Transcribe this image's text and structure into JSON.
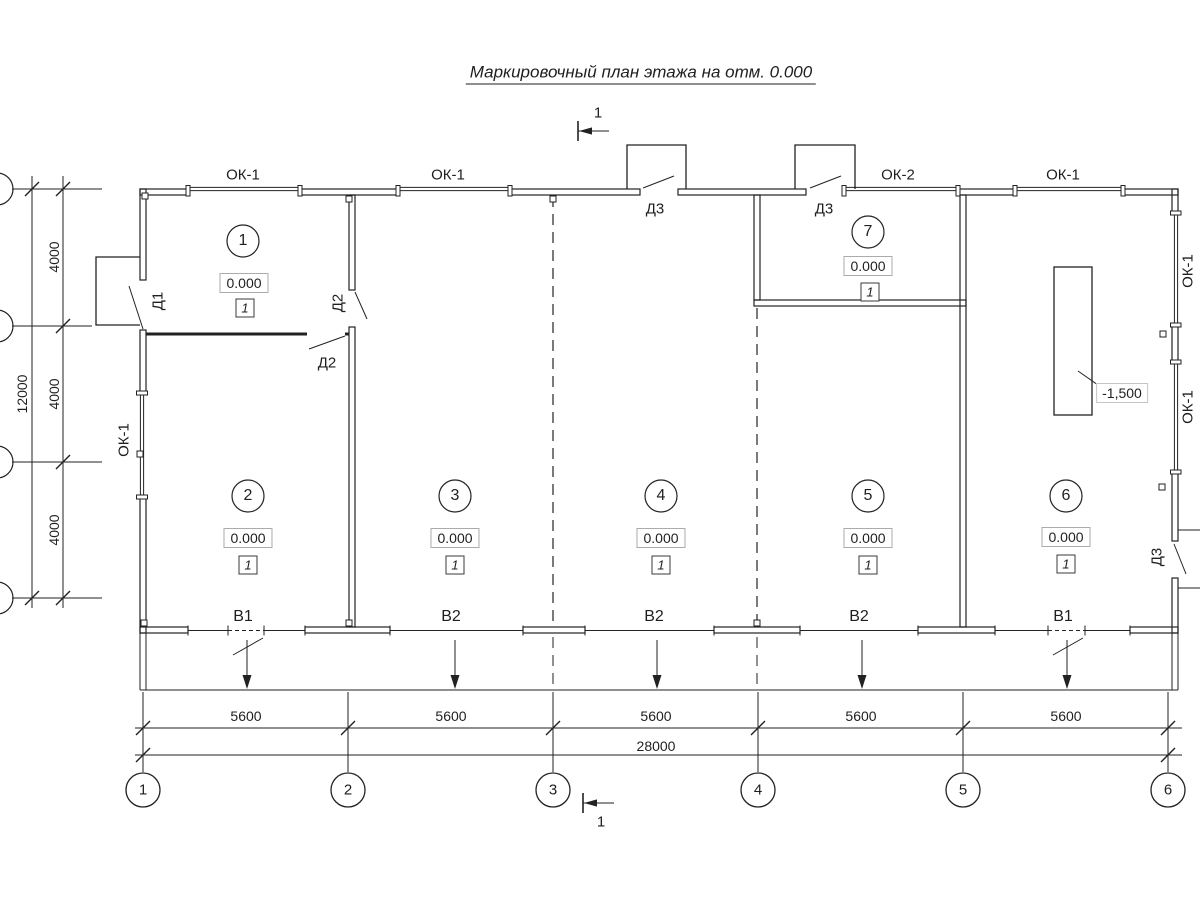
{
  "title": "Маркировочный план этажа на отм. 0.000",
  "section_mark": {
    "top": "1",
    "bottom": "1"
  },
  "rooms": [
    {
      "number": "1",
      "elevation": "0.000",
      "floor_type": "1"
    },
    {
      "number": "2",
      "elevation": "0.000",
      "floor_type": "1"
    },
    {
      "number": "3",
      "elevation": "0.000",
      "floor_type": "1"
    },
    {
      "number": "4",
      "elevation": "0.000",
      "floor_type": "1"
    },
    {
      "number": "5",
      "elevation": "0.000",
      "floor_type": "1"
    },
    {
      "number": "6",
      "elevation": "0.000",
      "floor_type": "1"
    },
    {
      "number": "7",
      "elevation": "0.000",
      "floor_type": "1"
    }
  ],
  "window_labels": {
    "top": [
      {
        "label": "ОК-1"
      },
      {
        "label": "ОК-1"
      },
      {
        "label": "ОК-2"
      },
      {
        "label": "ОК-1"
      }
    ],
    "left": {
      "label": "ОК-1"
    },
    "right": [
      {
        "label": "ОК-1"
      },
      {
        "label": "ОК-1"
      }
    ]
  },
  "door_labels": {
    "d1": "Д1",
    "d2_upper": "Д2",
    "d2_lower": "Д2",
    "d3_porch_left": "Д3",
    "d3_porch_right": "Д3",
    "d3_side": "Д3"
  },
  "drain_labels": [
    {
      "label": "В1"
    },
    {
      "label": "В2"
    },
    {
      "label": "В2"
    },
    {
      "label": "В2"
    },
    {
      "label": "В1"
    }
  ],
  "pit": {
    "depth": "-1,500"
  },
  "dimensions": {
    "bottom_spans": [
      {
        "value": "5600"
      },
      {
        "value": "5600"
      },
      {
        "value": "5600"
      },
      {
        "value": "5600"
      },
      {
        "value": "5600"
      }
    ],
    "bottom_total": "28000",
    "left_spans": [
      {
        "value": "4000"
      },
      {
        "value": "4000"
      },
      {
        "value": "4000"
      }
    ],
    "left_total": "12000"
  },
  "axes_bottom": [
    {
      "label": "1"
    },
    {
      "label": "2"
    },
    {
      "label": "3"
    },
    {
      "label": "4"
    },
    {
      "label": "5"
    },
    {
      "label": "6"
    }
  ],
  "colors": {
    "line": "#1f1f1f",
    "background": "#ffffff",
    "box_border": "#ababab"
  }
}
